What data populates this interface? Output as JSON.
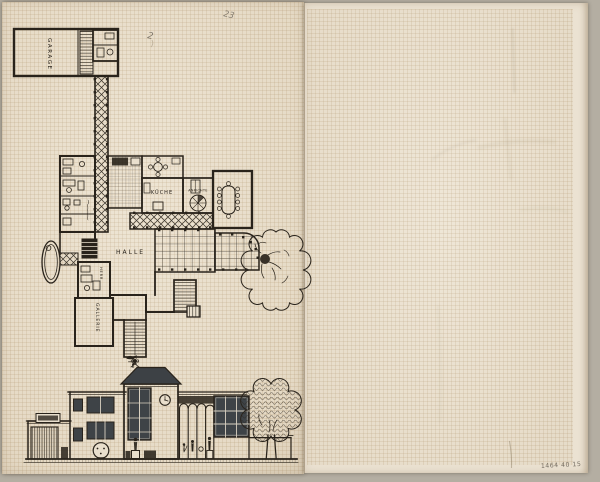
{
  "plan": {
    "labels": {
      "garage": "GARAGE",
      "kueche": "KÜCHE",
      "anrichte": "ANRICHTE",
      "halle": "HALLE",
      "herrenzimmer": "HERR.",
      "gallerie": "GALLERIE"
    }
  },
  "pencil": {
    "top_mark_a": "2",
    "top_mark_b": "23",
    "bottom_inscription": "1464 40 15"
  },
  "colors": {
    "scan_background": "#b4aea2",
    "paper_left": "#e9dfcd",
    "paper_right": "#ebe2d2",
    "grid_line": "#c9b695",
    "ink": "#29231b",
    "window_fill": "#3e4347",
    "pencil": "#93856c"
  }
}
